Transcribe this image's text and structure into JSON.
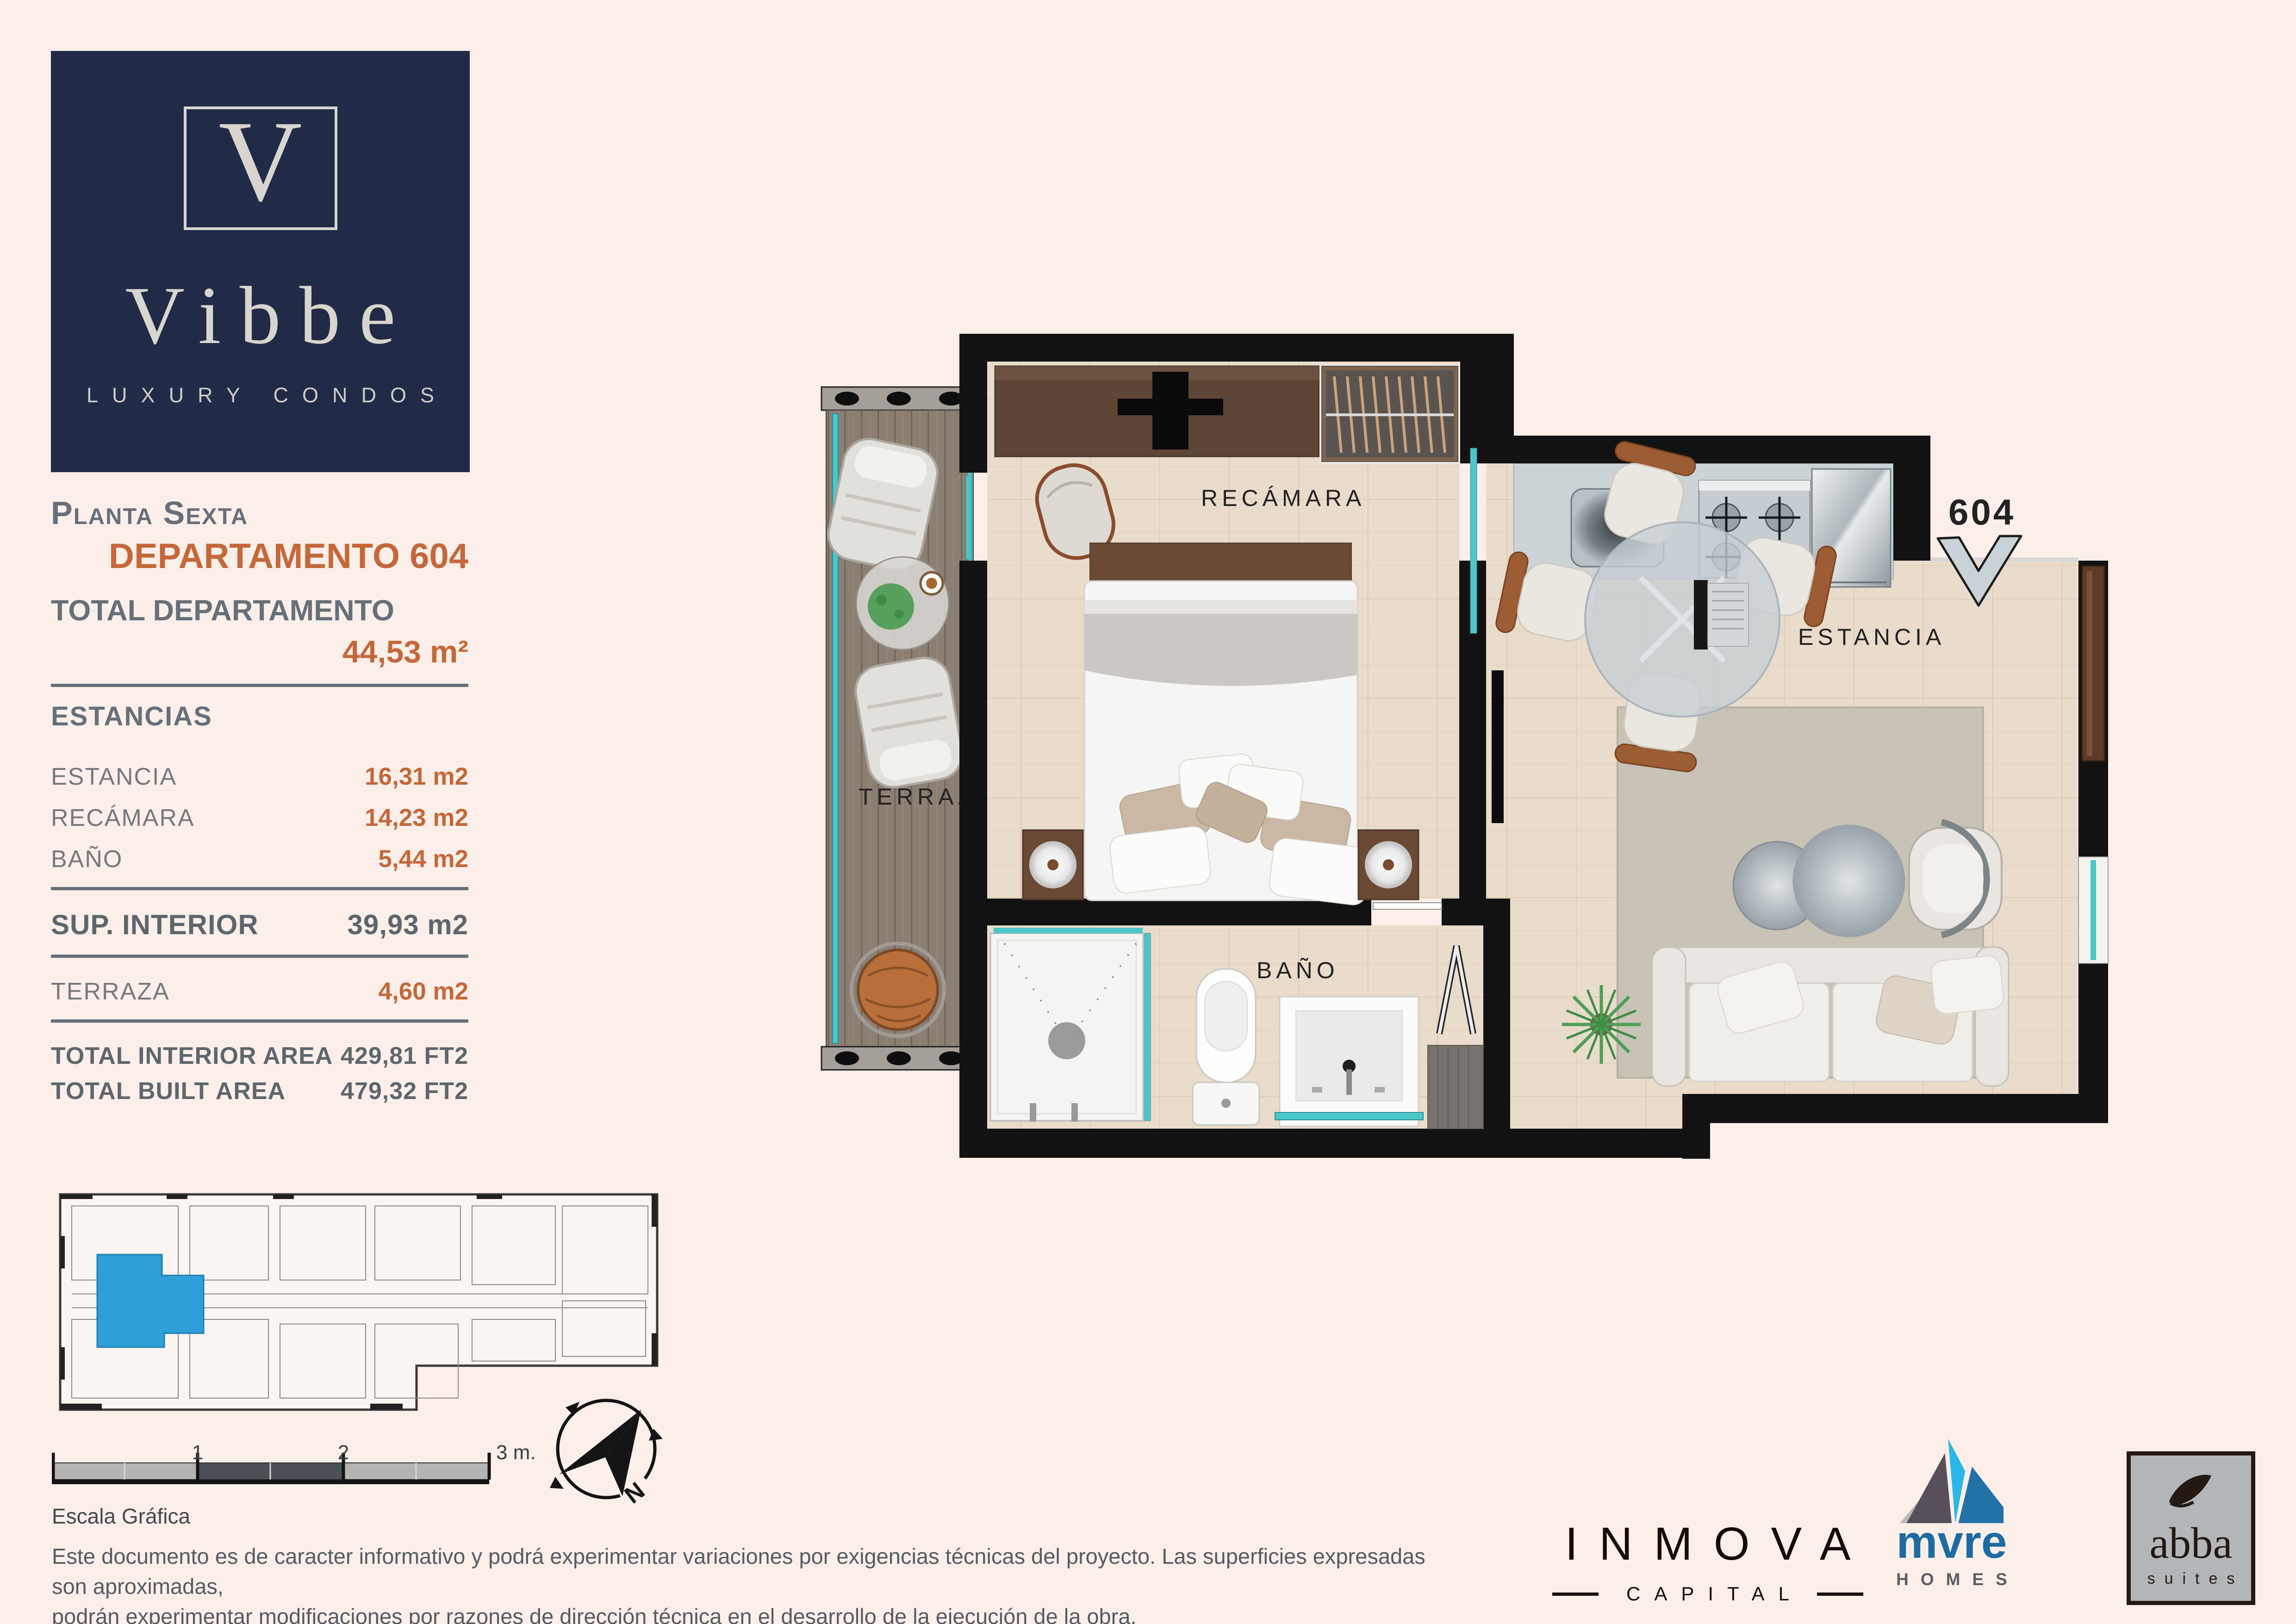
{
  "brand": {
    "initial": "V",
    "name": "Vibbe",
    "tagline": "LUXURY CONDOS"
  },
  "header": {
    "floor_label": "Planta Sexta",
    "unit_label": "DEPARTAMENTO 604"
  },
  "summary": {
    "total_label": "TOTAL DEPARTAMENTO",
    "total_value": "44,53 m²",
    "rooms_heading": "ESTANCIAS",
    "rooms": [
      {
        "label": "ESTANCIA",
        "value": "16,31 m2"
      },
      {
        "label": "RECÁMARA",
        "value": "14,23 m2"
      },
      {
        "label": "BAÑO",
        "value": "5,44 m2"
      }
    ],
    "interior": {
      "label": "SUP. INTERIOR",
      "value": "39,93 m2"
    },
    "terrace": {
      "label": "TERRAZA",
      "value": "4,60 m2"
    },
    "totals": [
      {
        "label": "TOTAL INTERIOR AREA",
        "value": "429,81 FT2"
      },
      {
        "label": "TOTAL BUILT AREA",
        "value": "479,32 FT2"
      }
    ]
  },
  "floorplan": {
    "unit_number": "604",
    "labels": {
      "terrace": "TERRAZA",
      "bedroom": "RECÁMARA",
      "bathroom": "BAÑO",
      "living": "ESTANCIA"
    }
  },
  "scalebar": {
    "ticks": [
      "1",
      "2",
      "3 m."
    ],
    "caption": "Escala Gráfica"
  },
  "compass": {
    "label": "N"
  },
  "disclaimer": {
    "line1": "Este documento es de caracter informativo y podrá experimentar variaciones por exigencias técnicas del proyecto. Las superficies expresadas son aproximadas,",
    "line2": "podrán experimentar modificaciones por razones de dirección técnica en el desarrollo de la ejecución de la obra."
  },
  "logos": {
    "inmova": {
      "name": "INMOVA",
      "sub": "CAPITAL"
    },
    "mvre": {
      "name": "mvre",
      "sub": "HOMES"
    },
    "abba": {
      "name": "abba",
      "sub": "suites"
    }
  },
  "colors": {
    "background": "#fcefe9",
    "navy": "#212a47",
    "accent_orange": "#c4673a",
    "text_gray": "#66707a",
    "wall_black": "#121212",
    "glass_teal": "#4cc7c9",
    "highlight_blue": "#2f9fd9",
    "floor_tile": "#e9dccb",
    "deck_wood": "#8b7f73"
  }
}
